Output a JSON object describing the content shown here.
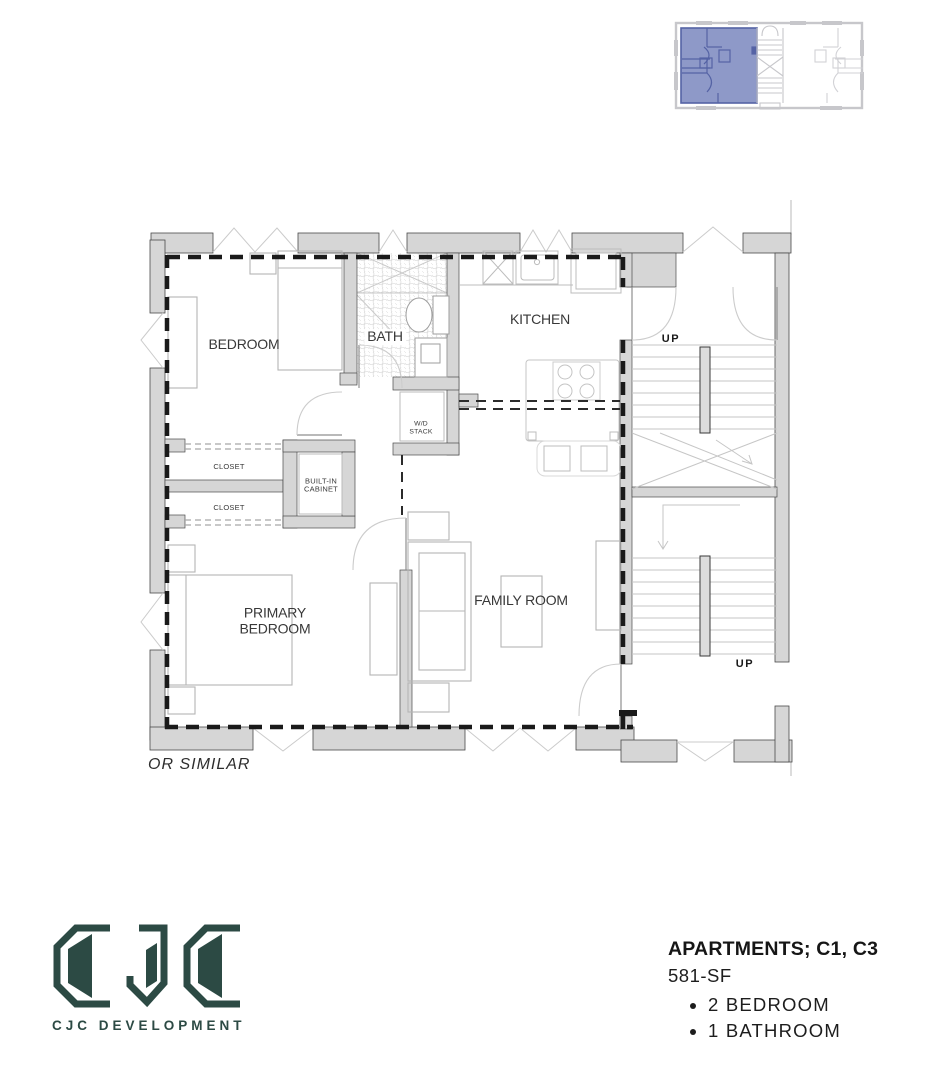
{
  "key_plan": {
    "description": "building key plan",
    "highlight_color": "#8e99c8",
    "line_color": "#c7c7cb"
  },
  "floor_plan": {
    "rooms": {
      "bedroom": "BEDROOM",
      "bath": "BATH",
      "kitchen": "KITCHEN",
      "primary_bedroom": "PRIMARY BEDROOM",
      "family_room": "FAMILY ROOM",
      "closet_1": "CLOSET",
      "closet_2": "CLOSET",
      "built_in_cabinet": "BUILT-IN CABINET",
      "wd_stack": "W/D STACK"
    },
    "stairs": {
      "up_label_1": "UP",
      "up_label_2": "UP"
    },
    "note": "OR SIMILAR"
  },
  "title_block": {
    "title": "APARTMENTS; C1, C3",
    "area": "581-SF",
    "features": [
      "2 BEDROOM",
      "1 BATHROOM"
    ]
  },
  "logo": {
    "wordmark": "CJC DEVELOPMENT",
    "brand_color": "#2c4a44"
  }
}
